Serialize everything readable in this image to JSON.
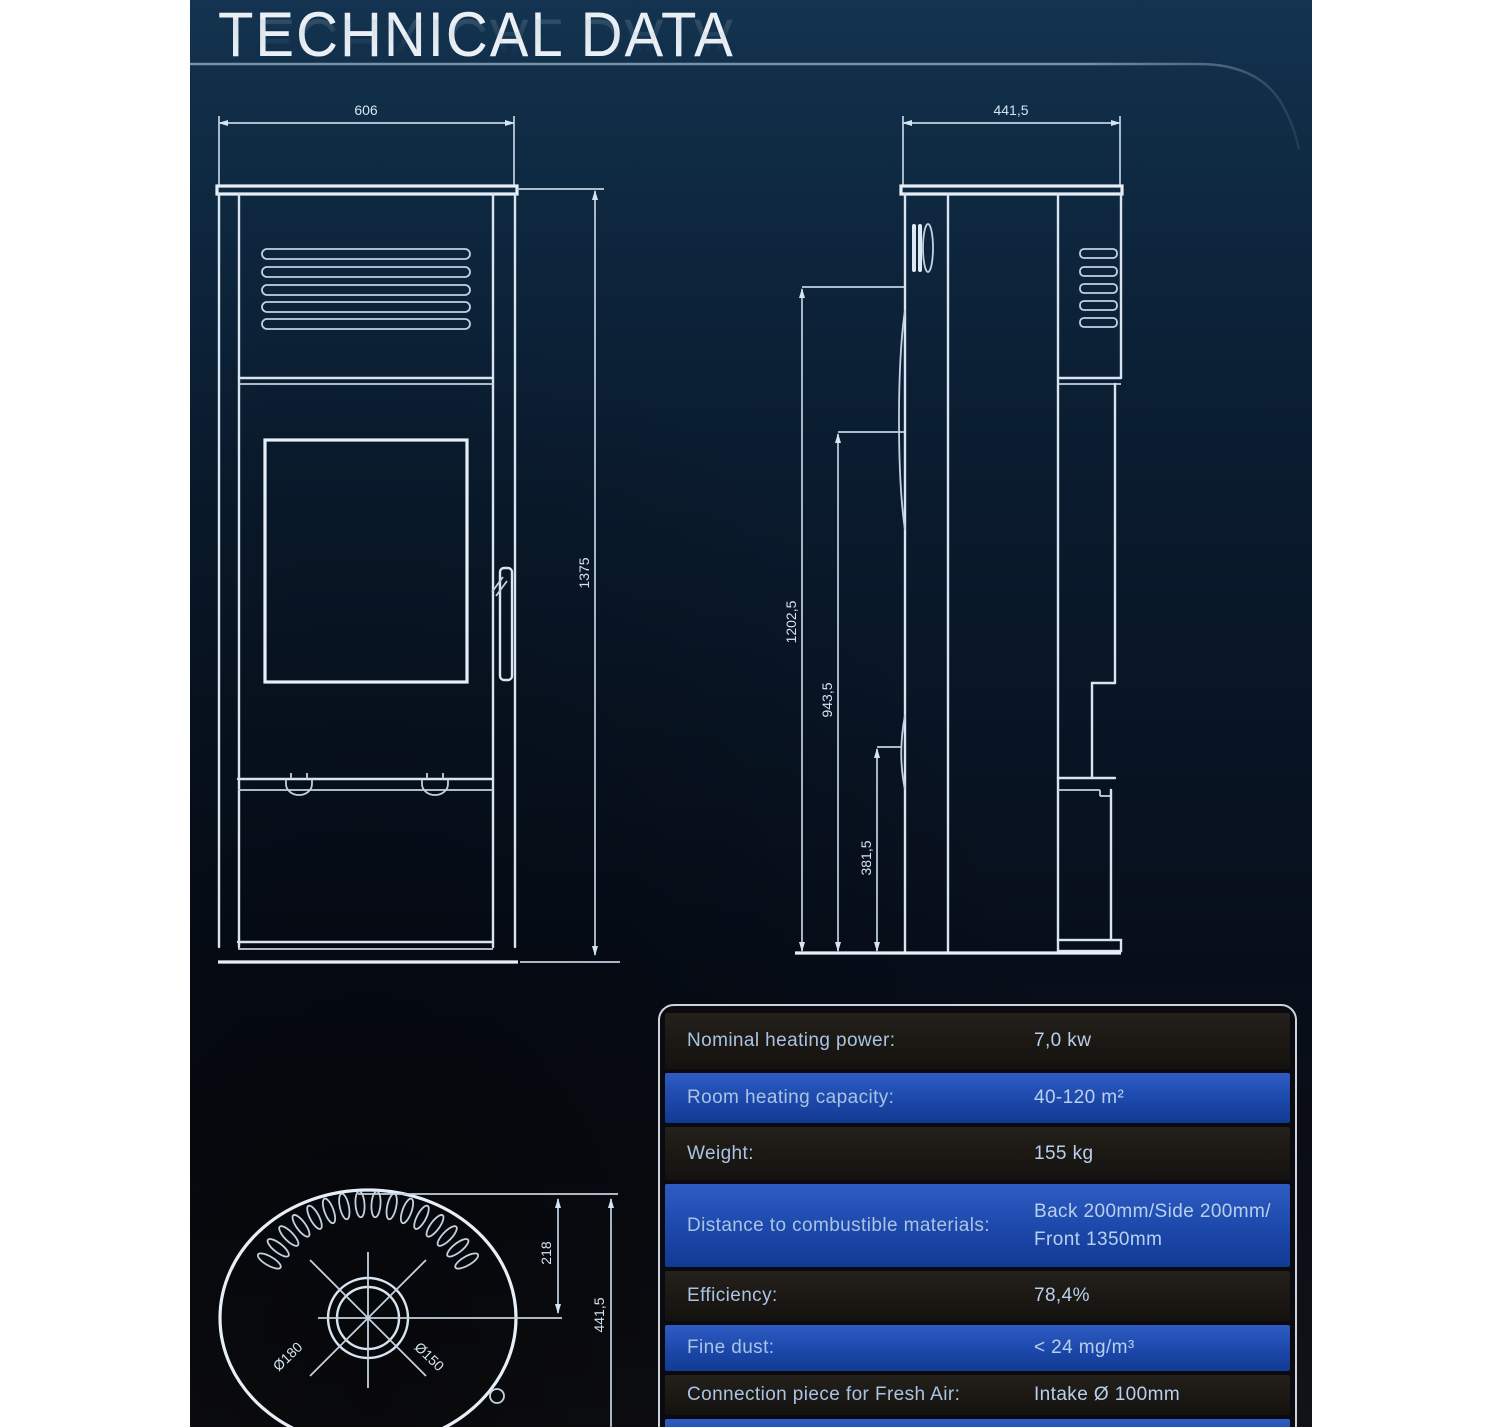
{
  "title": "TECHNICAL DATA",
  "drawings": {
    "front": {
      "width": "606",
      "height": "1375"
    },
    "side": {
      "depth": "441,5",
      "height_total": "1202,5",
      "height_mid": "943,5",
      "height_low": "381,5"
    },
    "top": {
      "flue_offset": "218",
      "depth": "441,5",
      "dia_outer": "Ø180",
      "dia_inner": "Ø150"
    }
  },
  "table": {
    "rows": [
      {
        "label": "Nominal heating power:",
        "value": "7,0 kw"
      },
      {
        "label": "Room heating capacity:",
        "value": "40-120 m²"
      },
      {
        "label": "Weight:",
        "value": "155 kg"
      },
      {
        "label": "Distance to combustible materials:",
        "value": "Back 200mm/Side 200mm/",
        "value2": "Front 1350mm"
      },
      {
        "label": "Efficiency:",
        "value": "78,4%"
      },
      {
        "label": "Fine dust:",
        "value": "< 24 mg/m³"
      },
      {
        "label": "Connection piece for Fresh Air:",
        "value": "Intake Ø 100mm"
      }
    ]
  },
  "colors": {
    "accent_row_blue": "#1c48aa",
    "dark_row": "#1b1814",
    "drawing_line": "#d8e4ef",
    "background_top": "#133350",
    "background_bottom": "#121318",
    "title_text": "#e9eff5"
  }
}
